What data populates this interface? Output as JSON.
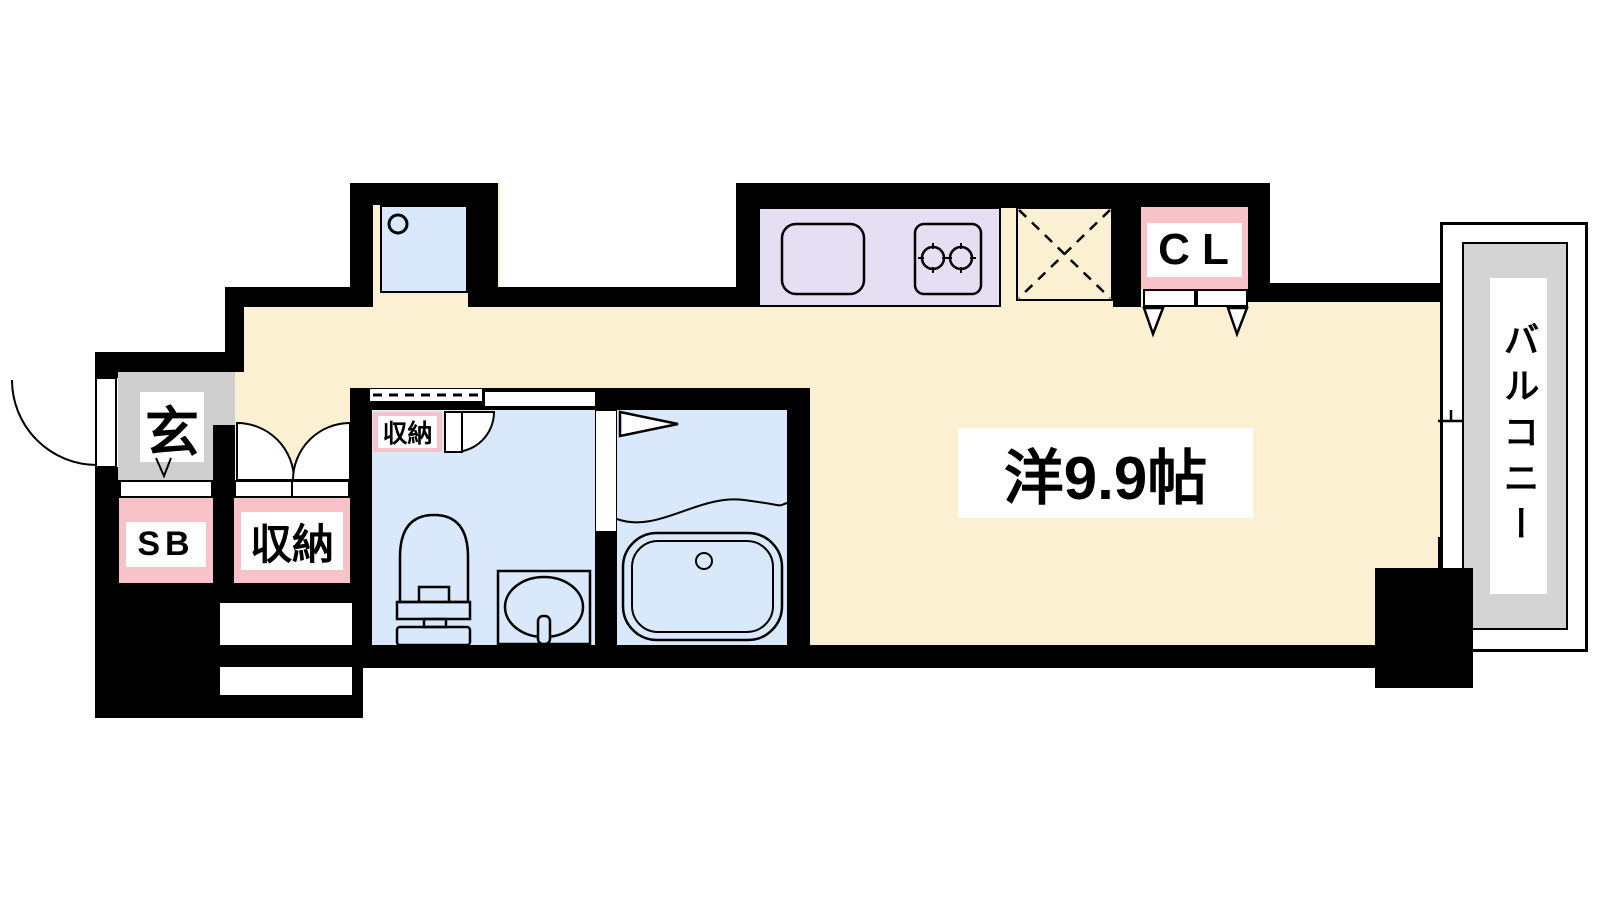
{
  "title": "apartment floor plan",
  "colors": {
    "floor": "#FCF0D2",
    "room_wet": "#D9E8FA",
    "kitchen": "#E6DEF2",
    "closet_pink": "#F8C3C8",
    "genkan_gray": "#CFCFCF",
    "balcony_gray": "#D4D4D4",
    "wall": "#000000"
  },
  "labels": {
    "genkan": "玄",
    "shoe_box": "SB",
    "storage_entry": "収納",
    "storage_washroom": "収納",
    "closet": "CL",
    "main_room": "洋9.9帖",
    "balcony": "バルコニー"
  }
}
